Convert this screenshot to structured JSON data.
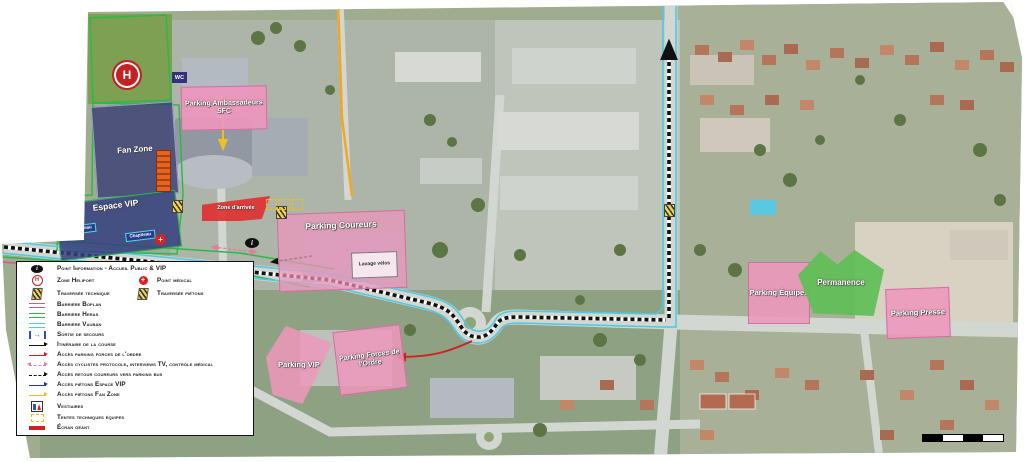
{
  "colors": {
    "boplan": "#d85a80",
    "heras": "#2db84b",
    "vauban": "#4ec9e6",
    "course": "#111111",
    "acces_fdo": "#cc2222",
    "acces_cyclistes": "#e080a0",
    "acces_vip": "#223a8c",
    "acces_fan": "#f0c020",
    "zone_pink": "#ee96bc",
    "zone_blue": "#3d4a86",
    "zone_red": "#de3232",
    "zone_green": "#60be56"
  },
  "legend": {
    "items": [
      {
        "icon": "info-point-icon",
        "label": "Point Information - Accueil Public & VIP"
      },
      {
        "icon": "heliport-icon",
        "label": "Zone Héliport"
      },
      {
        "icon": "medical-cross-icon",
        "label": "Point médical"
      },
      {
        "icon": "gate-icon",
        "label": "Traversée technique"
      },
      {
        "icon": "gate-icon",
        "label": "Traversée piétons"
      },
      {
        "icon": "barrier-line-pink",
        "label": "Barrière Boplan"
      },
      {
        "icon": "barrier-line-green",
        "label": "Barrière Heras"
      },
      {
        "icon": "barrier-line-cyan",
        "label": "Barrière Vauban"
      },
      {
        "icon": "emergency-exit-icon",
        "label": "Sortie de secours"
      },
      {
        "icon": "arrow-black",
        "label": "Itinéraire de la course"
      },
      {
        "icon": "arrow-red",
        "label": "Accès parking forces de l'ordre"
      },
      {
        "icon": "arrow-pink-dashed",
        "label": "Accès cyclistes protocole, interviews TV, contrôle médical"
      },
      {
        "icon": "arrow-black-dashed",
        "label": "Accès retour coureurs vers parking bus"
      },
      {
        "icon": "arrow-navy",
        "label": "Accès piétons Espace VIP"
      },
      {
        "icon": "arrow-yellow",
        "label": "Accès piétons Fan Zone"
      },
      {
        "icon": "restrooms-icon",
        "label": "Vestiaires"
      },
      {
        "icon": "tent-dashed-box",
        "label": "Tentes techniques équipes"
      },
      {
        "icon": "giant-screen-bar",
        "label": "Écran géant"
      }
    ]
  },
  "map": {
    "zones": {
      "fan_zone": "Fan Zone",
      "espace_vip": "Espace VIP",
      "chapiteau": "Chapiteau",
      "wc": "WC",
      "parking_ambassadeurs": "Parking Ambassadeurs SFC",
      "zone_arrivee": "Zone d'arrivée",
      "parking_coureurs": "Parking Coureurs",
      "lavage_velos": "Lavage vélos",
      "parking_vip": "Parking VIP",
      "parking_fdo": "Parking Forces de l'Ordre",
      "parking_equipes": "Parking Équipes",
      "permanence": "Permanence",
      "parking_presse": "Parking Presse"
    },
    "markers": {
      "heliport_letter": "H",
      "info_letter": "i"
    }
  }
}
